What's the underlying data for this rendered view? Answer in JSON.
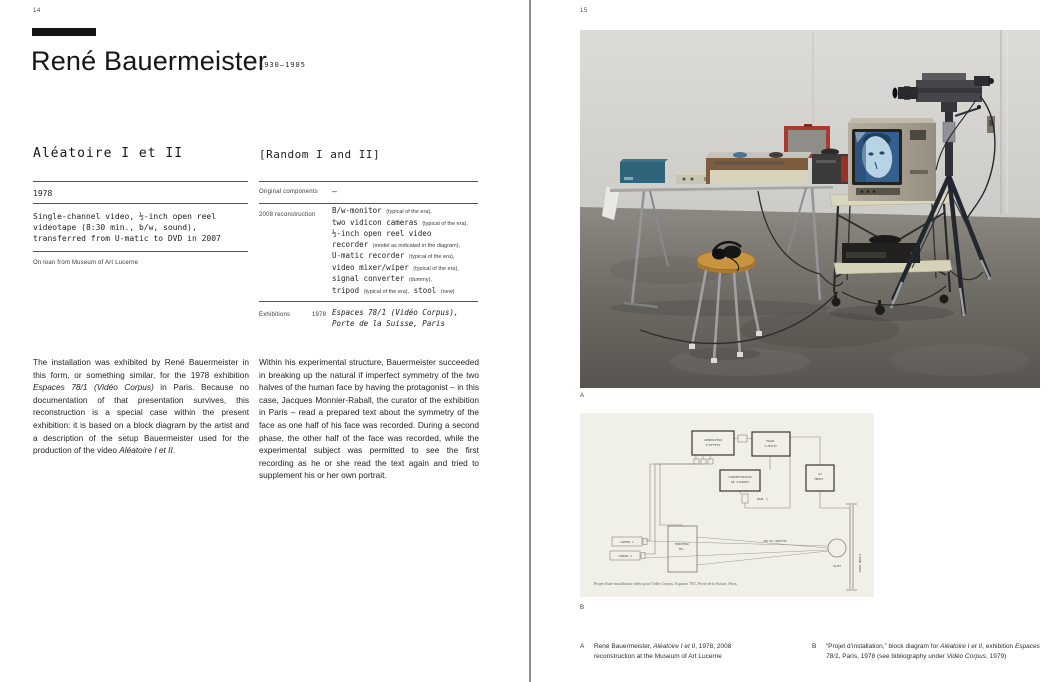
{
  "left_page": {
    "page_number": "14",
    "artist_name": "René Bauermeister",
    "life_dates": "1930–1985",
    "work": {
      "title_fr": "Aléatoire I et II",
      "title_en": "[Random I and II]",
      "year": "1978",
      "medium": "Single-channel video, ½-inch open reel videotape (8:30 min., b/w, sound), transferred from U-matic to DVD in 2007",
      "loan": "On loan from Museum of Art Lucerne"
    },
    "details": {
      "original_components_label": "Original components",
      "original_components_value": "—",
      "reconstruction_label": "2008 reconstruction",
      "component_lines": [
        [
          {
            "t": "B/w-monitor "
          },
          {
            "t": "(typical of the era),",
            "c": "note"
          }
        ],
        [
          {
            "t": "two vidicon cameras "
          },
          {
            "t": "(typical of the era),",
            "c": "note"
          }
        ],
        [
          {
            "t": "½-inch open reel video"
          }
        ],
        [
          {
            "t": "recorder "
          },
          {
            "t": "(model as indicated in the diagram),",
            "c": "note"
          }
        ],
        [
          {
            "t": "U-matic recorder "
          },
          {
            "t": "(typical of the era),",
            "c": "note"
          }
        ],
        [
          {
            "t": "video mixer/wiper "
          },
          {
            "t": "(typical of the era),",
            "c": "note"
          }
        ],
        [
          {
            "t": "signal converter "
          },
          {
            "t": "(dummy),",
            "c": "note"
          }
        ],
        [
          {
            "t": "tripod "
          },
          {
            "t": "(typical of the era),",
            "c": "note"
          },
          {
            "t": " stool "
          },
          {
            "t": "(new)",
            "c": "note"
          }
        ]
      ],
      "exhibitions_label": "Exhibitions",
      "exhibitions_year": "1978",
      "exhibition_line1": "Espaces 78/1 (Vidéo Corpus),",
      "exhibition_line2": "Porte de la Suisse, Paris"
    },
    "body_col1": [
      {
        "t": "The installation was exhibited by René Bauermeister in this form, or something similar, for the 1978 exhibition "
      },
      {
        "t": "Espaces 78/1 (Vidéo Corpus)",
        "c": "i"
      },
      {
        "t": " in Paris. Because no documentation of that presentation survives, this reconstruction is a special case within the present exhibition: it is based on a block diagram by the artist and a description of the setup Bauermeister used for the production of the video "
      },
      {
        "t": "Aléatoire I et II",
        "c": "i"
      },
      {
        "t": "."
      }
    ],
    "body_col2": [
      {
        "t": "Within his experimental structure, Bauermeister succeeded in breaking up the natural if imperfect symmetry of the two halves of the human face by having the protagonist – in this case, Jacques Monnier-Raball, the curator of the exhibition in Paris – read a prepared text about the symmetry of the face as one half of his face was recorded. During a second phase, the other half of the face was recorded, while the experimental subject was permitted to see the first recording as he or she read the text again and tried to supplement his or her own portrait."
      }
    ]
  },
  "right_page": {
    "page_number": "15",
    "figure_a_marker": "A",
    "figure_b_marker": "B",
    "diagram": {
      "label_effects_1": "GENERATEUR",
      "label_effects_2": "D'EFFETS",
      "label_umatic_1": "MAGN.",
      "label_umatic_2": "U-MATIC",
      "label_conc_1": "CONCENTRATEUR",
      "label_conc_2": "DE SIGNAUX",
      "label_av_1": "AV",
      "label_av_2": "MONIT.",
      "label_tv_1": "MONITEUR",
      "label_tv_2": "TEL.",
      "label_cam1": "CAMERA 1",
      "label_cam2": "CAMERA 2",
      "label_magn": "MAGN. ½",
      "label_axis": "AXE DE LUNETTES",
      "label_subject": "SUJET",
      "label_wall": "PAROI MOBILE",
      "caption": "Projet d'une installation vidéo pour Vidéo Corpus, Espaces 78/1, Porte de la Suisse, Paris."
    },
    "caption_a": [
      {
        "t": "René Bauermeister, "
      },
      {
        "t": "Aléatoire I et II",
        "c": "i"
      },
      {
        "t": ", 1978, 2008 reconstruction at the Museum of Art Lucerne"
      }
    ],
    "caption_b": [
      {
        "t": "“Projet d’installation,” block diagram for "
      },
      {
        "t": "Aléatoire I et II",
        "c": "i"
      },
      {
        "t": ", exhibition "
      },
      {
        "t": "Espaces 78/1",
        "c": "i"
      },
      {
        "t": ", Paris, 1978 (see bibliography under "
      },
      {
        "t": "Vidéo Corpus",
        "c": "i"
      },
      {
        "t": ", 1979)"
      }
    ],
    "colors": {
      "screen_blue": "#34608f",
      "cart_cream": "#dbd7bd",
      "stool_wood": "#c9933f",
      "case_red": "#a93a2e",
      "box_teal": "#30647a"
    }
  }
}
